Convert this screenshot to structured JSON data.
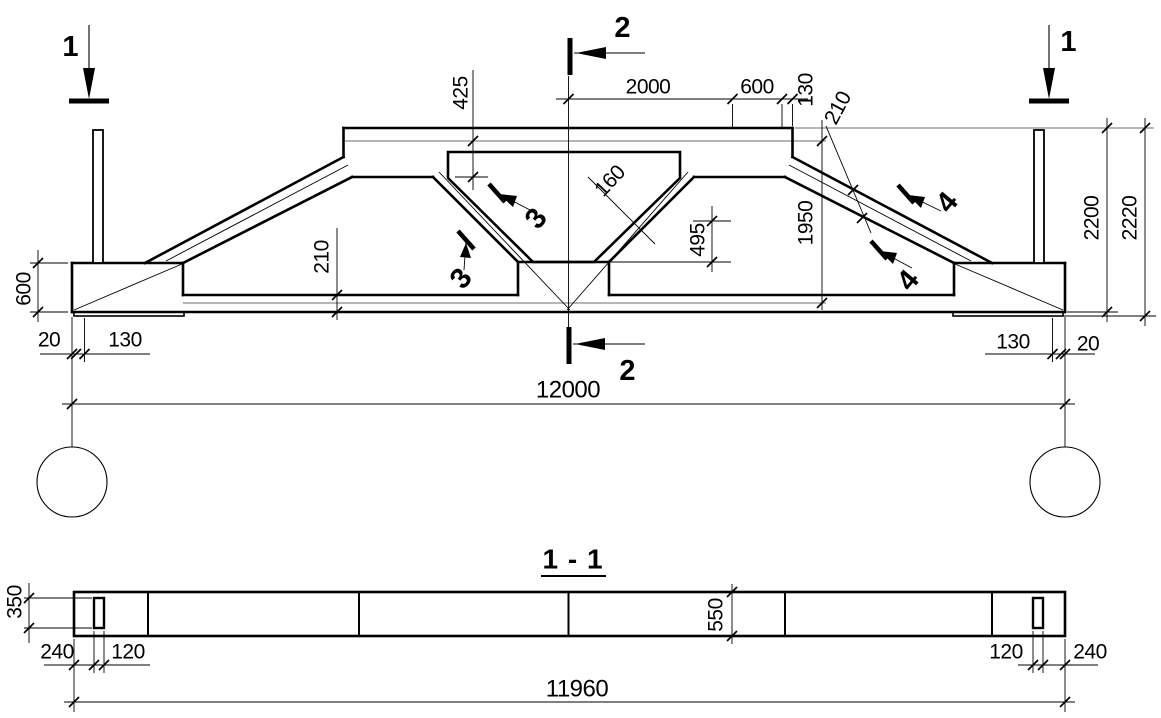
{
  "drawing_type": "beam-technical-drawing",
  "colors": {
    "line": "#000000",
    "axis_gray": "#8b8b8b",
    "background": "#ffffff"
  },
  "elevation": {
    "section_marks": {
      "left_1": "1",
      "right_1": "1",
      "top_2": "2",
      "bottom_2": "2",
      "diag3_upper": "3",
      "diag3_lower": "3",
      "slope4_upper": "4",
      "slope4_lower": "4"
    },
    "dims": {
      "d425": "425",
      "d2000": "2000",
      "d600_top": "600",
      "d130_top": "130",
      "d160": "160",
      "d495": "495",
      "d210_slope": "210",
      "d1950": "1950",
      "d2200": "2200",
      "d2220": "2220",
      "d600_left": "600",
      "d210_chord": "210",
      "d20_left": "20",
      "d130_left": "130",
      "d130_right": "130",
      "d20_right": "20",
      "d12000": "12000"
    }
  },
  "section_1_1": {
    "title": "1 - 1",
    "dims": {
      "d350": "350",
      "d550": "550",
      "d240_left": "240",
      "d120_left": "120",
      "d120_right": "120",
      "d240_right": "240",
      "d11960": "11960"
    }
  }
}
